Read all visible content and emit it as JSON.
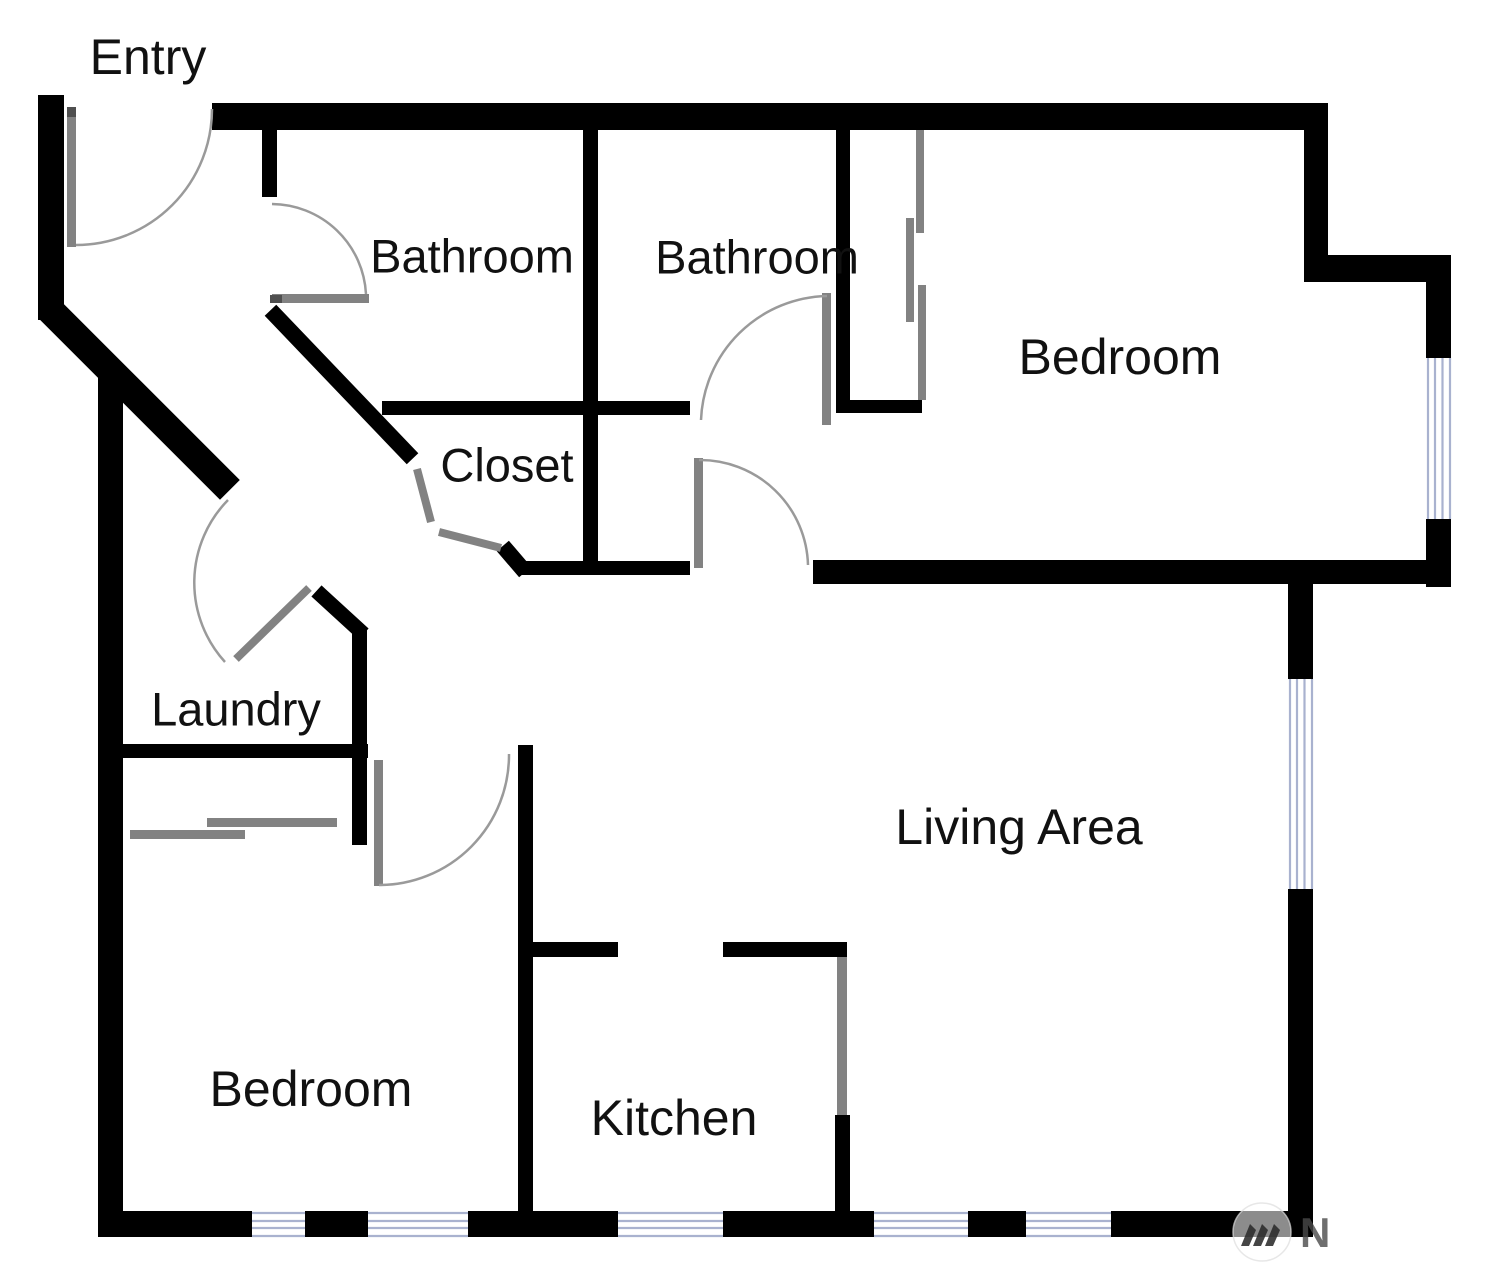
{
  "rooms": {
    "entry": "Entry",
    "bathroom_1": "Bathroom",
    "bathroom_2": "Bathroom",
    "bedroom_upper": "Bedroom",
    "closet": "Closet",
    "laundry": "Laundry",
    "living_area": "Living Area",
    "bedroom_lower": "Bedroom",
    "kitchen": "Kitchen"
  },
  "watermark": {
    "letter": "N",
    "icon": "three-peaks-logo-icon"
  },
  "colors": {
    "wall": "#000000",
    "door_leaf": "#828282",
    "door_swing_arc": "#9a9a9a",
    "window_line": "#a9b2cf",
    "label_text": "#111111",
    "background": "#ffffff"
  }
}
